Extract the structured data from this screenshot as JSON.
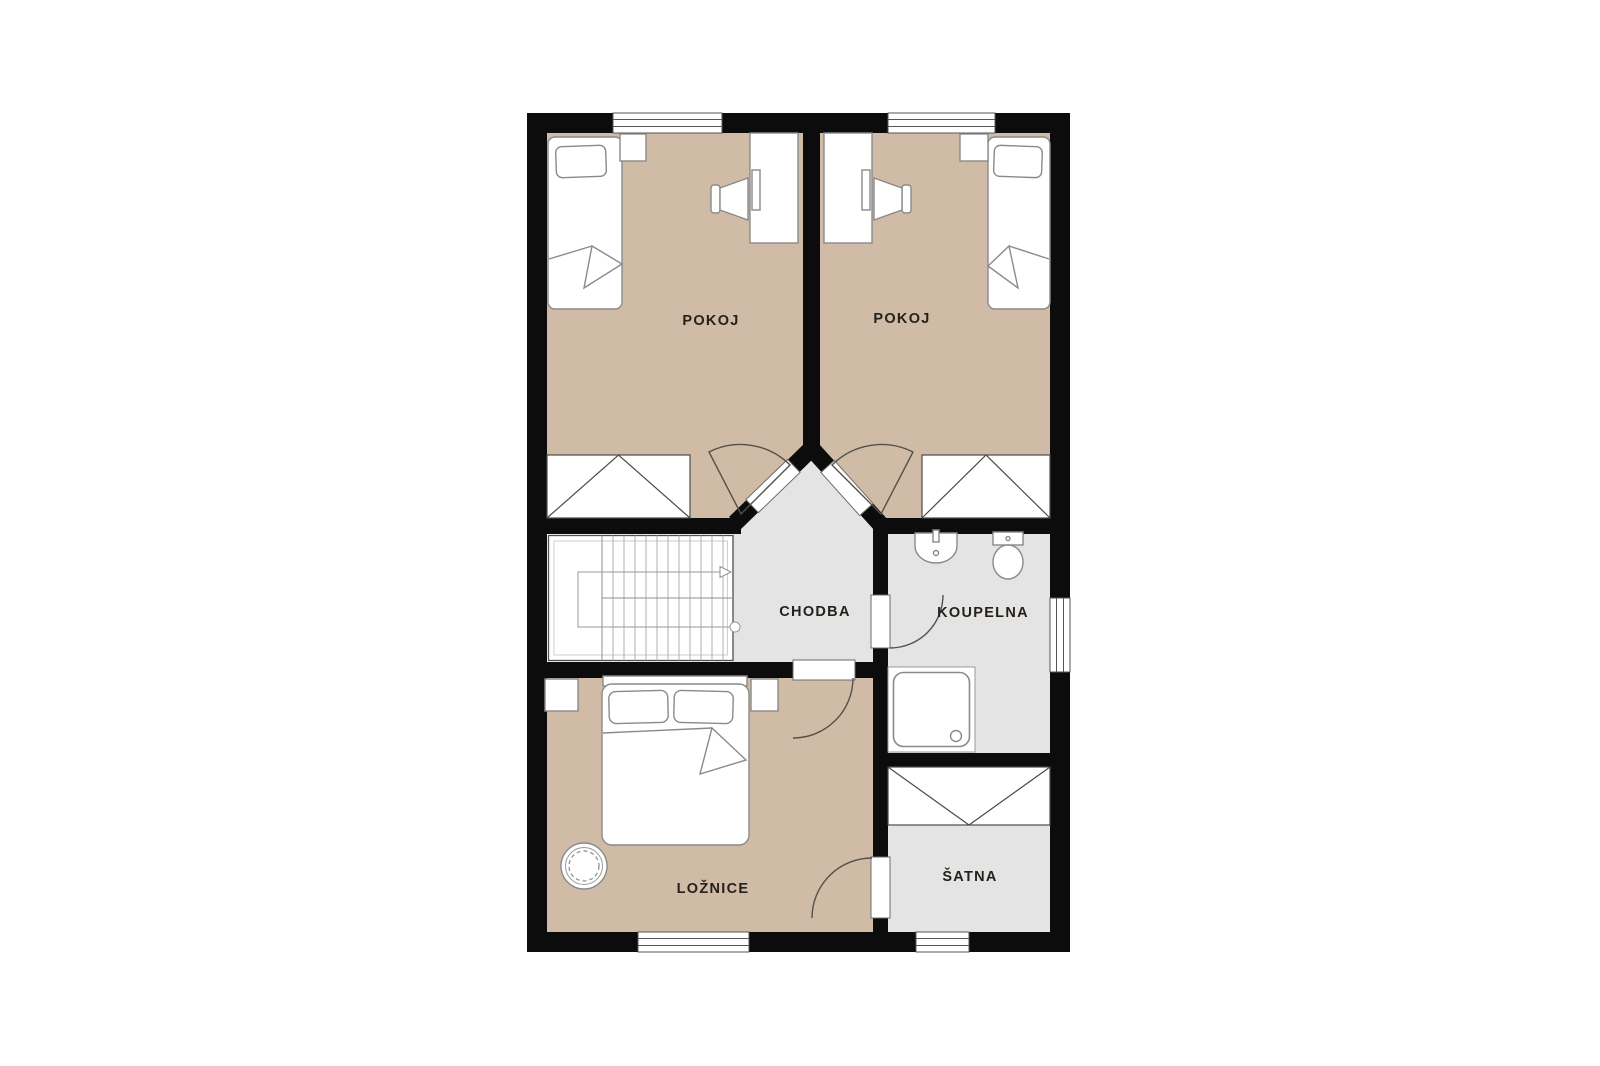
{
  "floorplan": {
    "type": "residential-floor-plan-upper-floor",
    "rooms": [
      {
        "id": "pokoj-left",
        "label": "POKOJ",
        "floor_color": "#d0bca6",
        "furniture": [
          "single-bed",
          "pillow",
          "nightstand",
          "desk",
          "monitor",
          "chair",
          "wardrobe",
          "window",
          "door"
        ]
      },
      {
        "id": "pokoj-right",
        "label": "POKOJ",
        "floor_color": "#d0bca6",
        "furniture": [
          "single-bed",
          "pillow",
          "nightstand",
          "desk",
          "monitor",
          "chair",
          "wardrobe",
          "window",
          "door"
        ]
      },
      {
        "id": "chodba",
        "label": "CHODBA",
        "floor_color": "#e4e4e4",
        "furniture": [
          "staircase",
          "stair-direction-arrow"
        ]
      },
      {
        "id": "koupelna",
        "label": "KOUPELNA",
        "floor_color": "#e4e4e4",
        "furniture": [
          "sink",
          "toilet",
          "shower",
          "window",
          "door"
        ]
      },
      {
        "id": "loznice",
        "label": "LOŽNICE",
        "floor_color": "#d0bca6",
        "furniture": [
          "double-bed",
          "pillow",
          "pillow",
          "nightstand",
          "nightstand",
          "potted-plant",
          "window",
          "door"
        ]
      },
      {
        "id": "satna",
        "label": "ŠATNA",
        "floor_color": "#e4e4e4",
        "furniture": [
          "wardrobe",
          "window",
          "door"
        ]
      }
    ],
    "colors": {
      "wall": "#0c0c0c",
      "floor_tan": "#d0bca6",
      "floor_gray": "#e4e4e4",
      "furniture_stroke": "#8a8a8a",
      "door_arc": "#55504a",
      "label_text": "#26201b",
      "background": "#ffffff"
    }
  }
}
